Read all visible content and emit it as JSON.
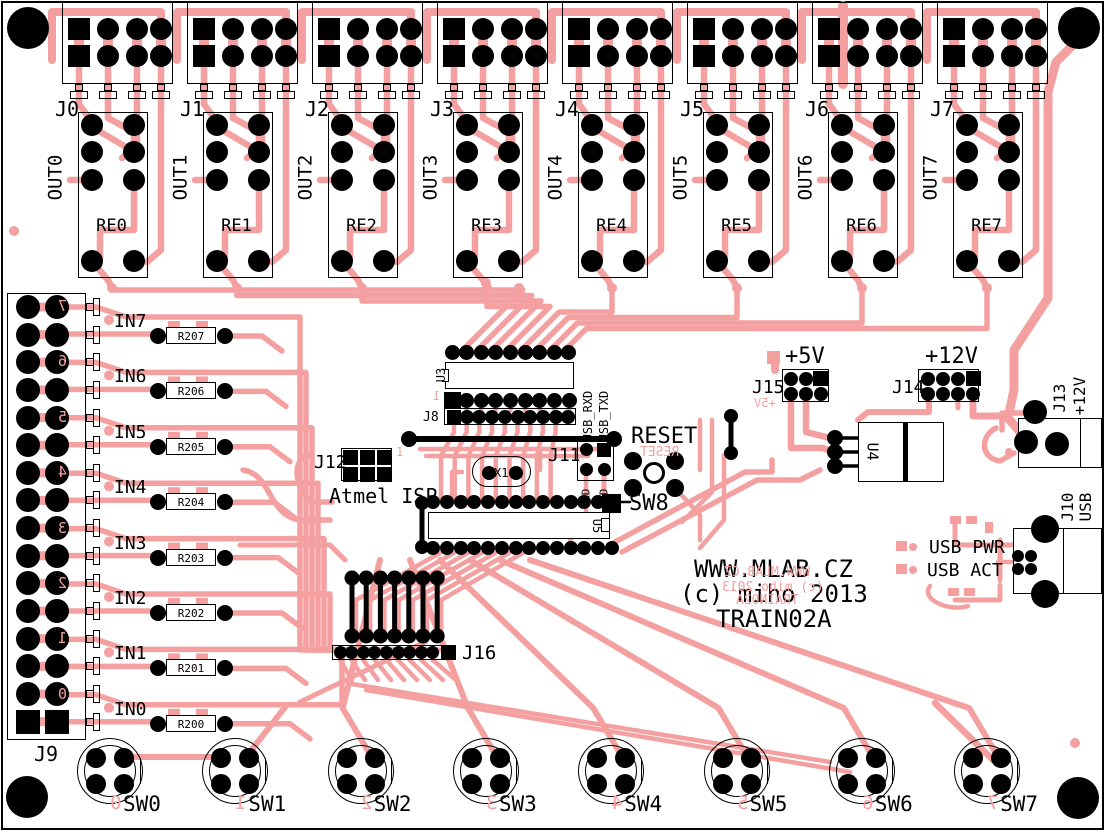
{
  "colors": {
    "trace": "#F4A0A0",
    "silk": "#000000",
    "board": "#FFFFFF"
  },
  "top_connectors": [
    {
      "label": "J0"
    },
    {
      "label": "J1"
    },
    {
      "label": "J2"
    },
    {
      "label": "J3"
    },
    {
      "label": "J4"
    },
    {
      "label": "J5"
    },
    {
      "label": "J6"
    },
    {
      "label": "J7"
    }
  ],
  "relays": [
    {
      "label": "RE0",
      "out": "OUT0"
    },
    {
      "label": "RE1",
      "out": "OUT1"
    },
    {
      "label": "RE2",
      "out": "OUT2"
    },
    {
      "label": "RE3",
      "out": "OUT3"
    },
    {
      "label": "RE4",
      "out": "OUT4"
    },
    {
      "label": "RE5",
      "out": "OUT5"
    },
    {
      "label": "RE6",
      "out": "OUT6"
    },
    {
      "label": "RE7",
      "out": "OUT7"
    }
  ],
  "left": {
    "j9_label": "J9",
    "channels": [
      {
        "in": "IN7",
        "res": "R207",
        "digit": "7"
      },
      {
        "in": "IN6",
        "res": "R206",
        "digit": "6"
      },
      {
        "in": "IN5",
        "res": "R205",
        "digit": "5"
      },
      {
        "in": "IN4",
        "res": "R204",
        "digit": "4"
      },
      {
        "in": "IN3",
        "res": "R203",
        "digit": "3"
      },
      {
        "in": "IN2",
        "res": "R202",
        "digit": "2"
      },
      {
        "in": "IN1",
        "res": "R201",
        "digit": "1"
      },
      {
        "in": "IN0",
        "res": "R200",
        "digit": "0"
      }
    ]
  },
  "bottom": {
    "j16_label": "J16",
    "switches": [
      {
        "label": "SW0",
        "digit": "0"
      },
      {
        "label": "SW1",
        "digit": "1"
      },
      {
        "label": "SW2",
        "digit": "2"
      },
      {
        "label": "SW3",
        "digit": "3"
      },
      {
        "label": "SW4",
        "digit": "4"
      },
      {
        "label": "SW5",
        "digit": "5"
      },
      {
        "label": "SW6",
        "digit": "6"
      },
      {
        "label": "SW7",
        "digit": "7"
      }
    ]
  },
  "center": {
    "u3": "U3",
    "u3_pin1": "1",
    "j8": "J8",
    "usb_rxd": "USB_RXD",
    "usb_txd": "USB_TXD",
    "j11": "J11",
    "txd": "TXD",
    "rxd": "RXD",
    "j12": "J12",
    "j12_pin1": "1",
    "atmel_isp": "Atmel ISP",
    "x1": "X1",
    "reset": "RESET",
    "reset_mirror": "RESET",
    "sw8": "SW8",
    "u5": "U5"
  },
  "right": {
    "plus5": "+5V",
    "j15": "J15",
    "plus5_mirror": "+5V",
    "plus12": "+12V",
    "j14": "J14",
    "u4": "U4",
    "j13": "J13",
    "j13_volt": "+12V",
    "j10": "J10",
    "j10_usb": "USB",
    "usb_pwr": "USB PWR",
    "usb_act": "USB ACT"
  },
  "branding": {
    "line1": "WWW.MLAB.CZ",
    "line2": "(c) miho 2013",
    "line3": "TRAIN02A",
    "mirror1": "WWW.MLAB.CZ",
    "mirror2": "(c) miho 2013",
    "mirror3": "TRAIN02A"
  }
}
